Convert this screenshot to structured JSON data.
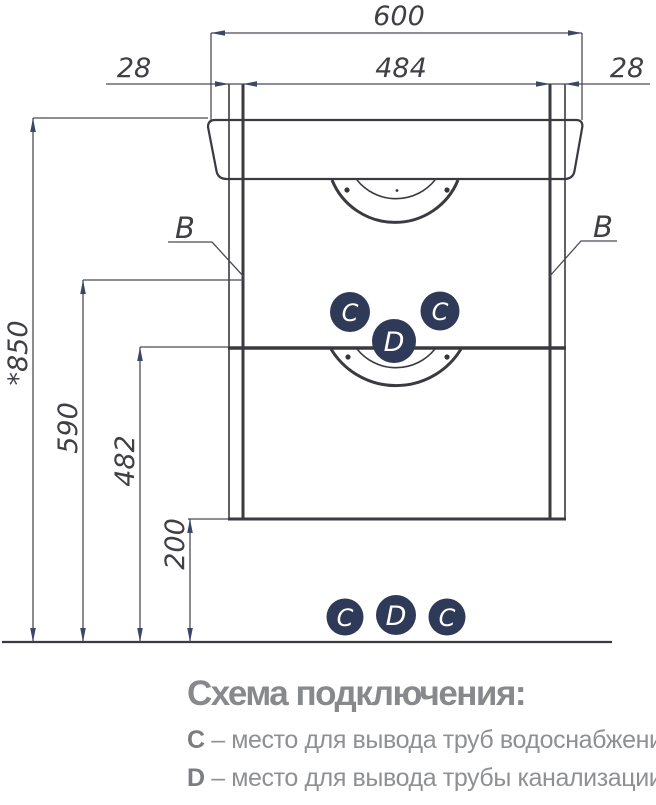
{
  "drawing": {
    "dims": {
      "width_total": "600",
      "width_inner": "484",
      "panel_left": "28",
      "panel_right": "28",
      "height_total": "*850",
      "height_upper": "590",
      "height_shelf": "482",
      "height_clearance": "200"
    },
    "section_labels": {
      "b_left": "B",
      "b_right": "B"
    },
    "markers": {
      "c": "C",
      "d": "D"
    },
    "colors": {
      "marker_bg": "#2e3a58",
      "marker_text": "#ffffff",
      "line": "#3a3a40",
      "dim_line": "#4b4b53",
      "arrow": "#3b4766",
      "legend_gray": "#8e9093"
    }
  },
  "legend": {
    "title": "Схема подключения:",
    "items": [
      {
        "key": "C",
        "desc": "– место для вывода труб водоснабжения"
      },
      {
        "key": "D",
        "desc": "– место для вывода трубы канализации"
      }
    ]
  }
}
